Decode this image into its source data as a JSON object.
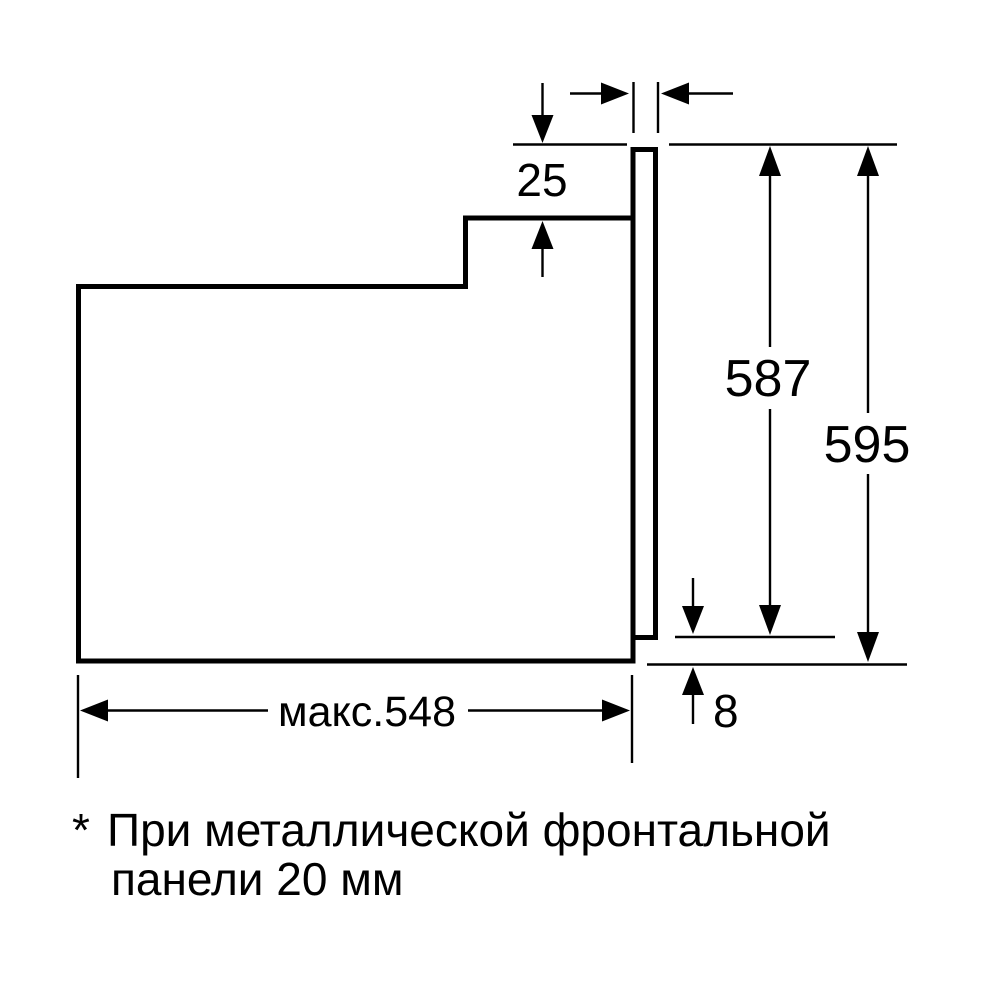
{
  "diagram": {
    "ink_color": "#000000",
    "background_color": "#ffffff"
  },
  "dimensions": {
    "top_gap": "25",
    "body_height": "587",
    "overall_height": "595",
    "max_depth": "макс.548",
    "bottom_offset": "8"
  },
  "footnote": {
    "marker": "*",
    "line1": "При металлической фронтальной",
    "line2": "панели 20 мм"
  }
}
